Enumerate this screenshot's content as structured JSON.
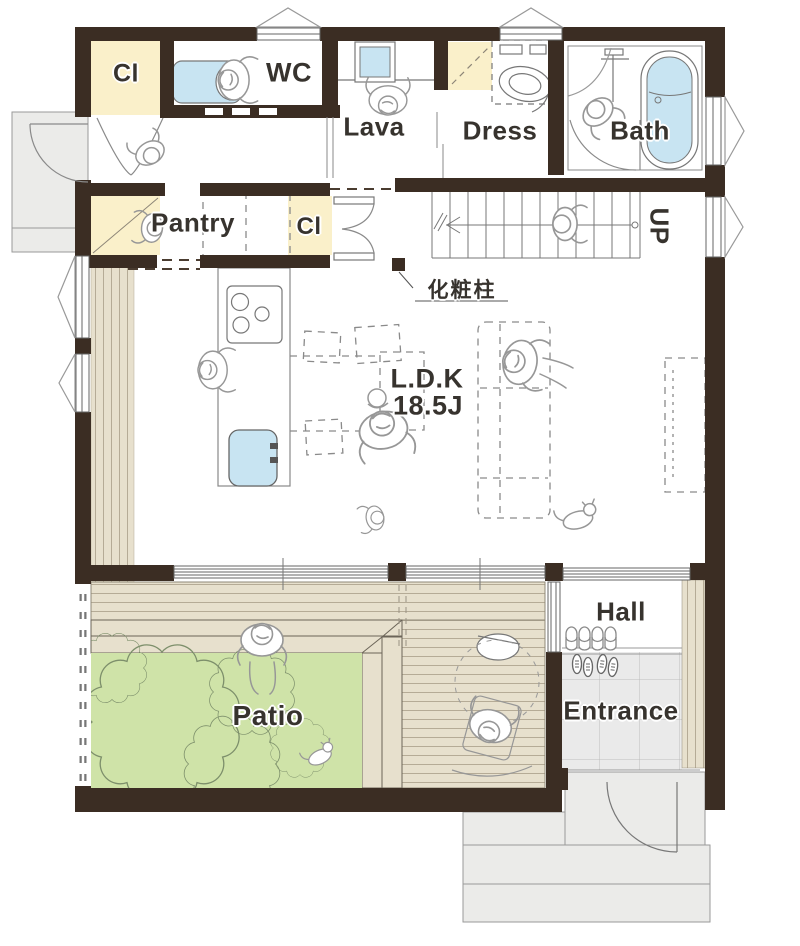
{
  "labels": {
    "cl_top": "Cl",
    "wc": "WC",
    "lava": "Lava",
    "dress": "Dress",
    "bath": "Bath",
    "pantry": "Pantry",
    "cl_mid": "Cl",
    "ldk_line1": "L.D.K",
    "ldk_line2": "18.5J",
    "up": "UP",
    "pillar_note": "化粧柱",
    "hall": "Hall",
    "entrance": "Entrance",
    "patio": "Patio"
  },
  "icons": [
    "toilet-icon",
    "wash-basin-icon",
    "washing-machine-icon",
    "bathtub-icon",
    "shower-icon",
    "stove-icon",
    "kitchen-sink-icon",
    "dining-set-icon",
    "sofa-icon",
    "tv-board-icon",
    "stairs-icon",
    "slippers-icon",
    "shoes-icon",
    "garden-table-icon",
    "bush-icon",
    "person-icon",
    "dog-icon",
    "cat-icon"
  ],
  "colors": {
    "wall": "#3b2d23",
    "closet": "#faf0ca",
    "fixture": "#c8e4f2",
    "deck": "#e7e0cd",
    "deck_stripe": "#b5ab96",
    "lawn": "#cfe3a8",
    "bush_line": "#7d8f6b",
    "tile": "#eaeaea",
    "porch": "#ebebe9",
    "line": "#777777",
    "label": "#37332e"
  }
}
